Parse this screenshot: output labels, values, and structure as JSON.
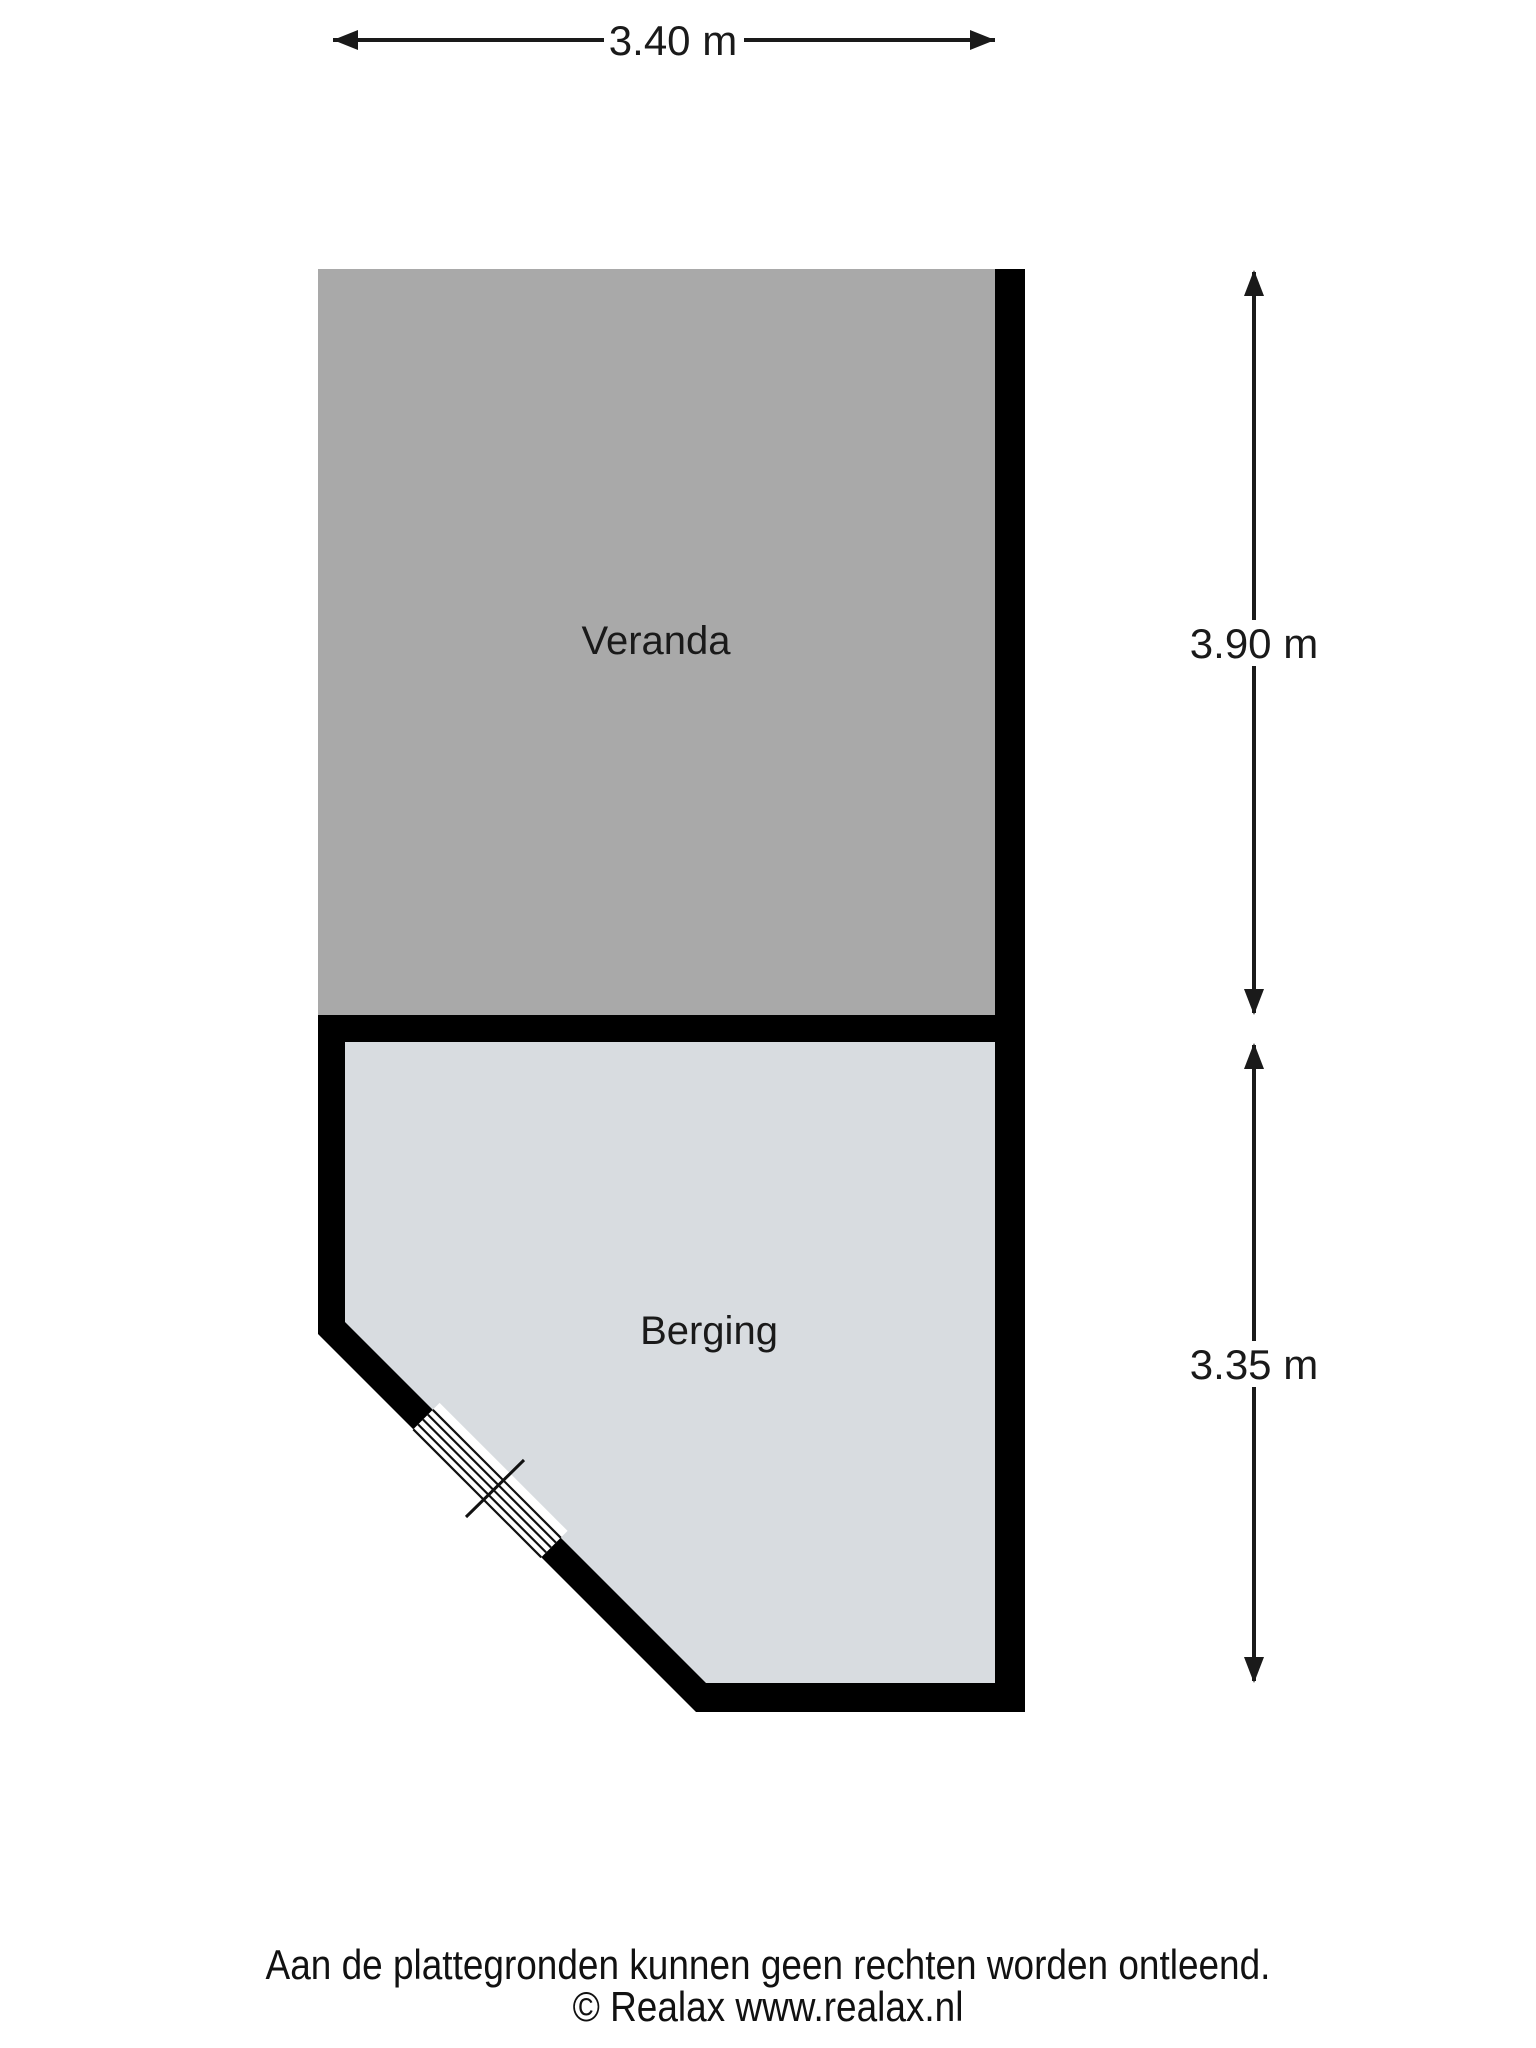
{
  "floorplan": {
    "wall_color": "#000000",
    "line_color": "#1a1a1a",
    "rooms": [
      {
        "name": "Veranda",
        "floor_color": "#a9a9a9"
      },
      {
        "name": "Berging",
        "floor_color": "#d8dce0"
      }
    ],
    "dimensions": {
      "top_width": "3.40 m",
      "veranda_height": "3.90 m",
      "berging_height": "3.35 m"
    }
  },
  "footer": {
    "disclaimer": "Aan de plattegronden kunnen geen rechten worden ontleend.",
    "copyright": "© Realax www.realax.nl"
  }
}
